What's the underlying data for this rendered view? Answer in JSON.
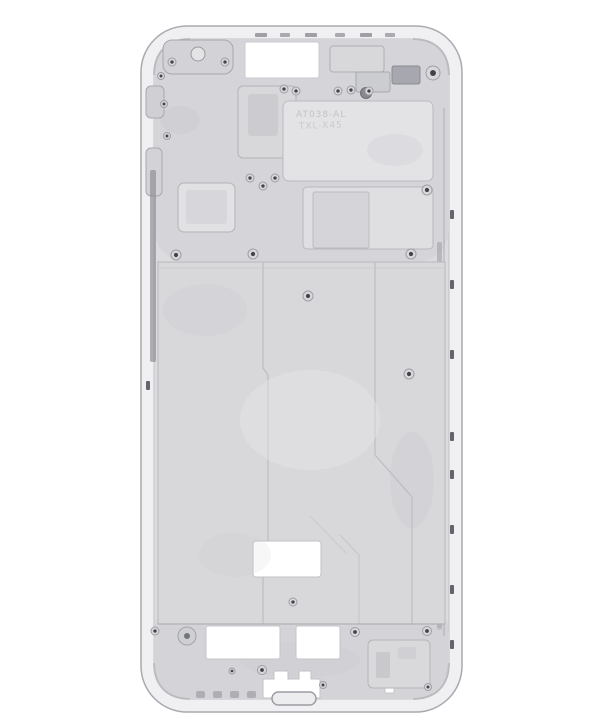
{
  "meta": {
    "subject": "smartphone-mid-frame-photo",
    "background": "#ffffff"
  },
  "palette": {
    "rim": "#f0f0f2",
    "rim_edge": "#a9a9af",
    "cavity": "#dcdcdf",
    "cavity_edge": "#c2c2c7",
    "zone": "#d5d5d9",
    "plate": "#d8d8db",
    "plate_edge": "#b9b9be",
    "cutout": "#ffffff",
    "cutout_edge": "#c4c4c9",
    "screw_ring": "#d8d8dc",
    "screw_edge": "#9e9ea4",
    "screw_hole": "#43434a",
    "groove_dark": "#8f8f96",
    "tick_dark": "#64646c"
  },
  "engraving": {
    "line1": "AT038-AL",
    "line2": "TXL-X45"
  },
  "svg": {
    "viewBox": "0 0 600 726",
    "width": 600,
    "height": 726,
    "shapes": [
      {
        "type": "rect",
        "name": "background",
        "x": 0,
        "y": 0,
        "w": 600,
        "h": 726,
        "fill": "#ffffff"
      },
      {
        "type": "rect",
        "name": "outer-frame-rim",
        "x": 141,
        "y": 26,
        "w": 321,
        "h": 686,
        "rx": 46,
        "fill": "#f0f0f2",
        "stroke": "#a9a9af",
        "sw": 1.5
      },
      {
        "type": "rect",
        "name": "inner-cavity",
        "x": 154,
        "y": 39,
        "w": 295,
        "h": 660,
        "rx": 33,
        "fill": "#dcdcdf",
        "stroke": "#c2c2c7",
        "sw": 1
      },
      {
        "type": "rect",
        "name": "top-machined-zone",
        "x": 154,
        "y": 39,
        "w": 295,
        "h": 223,
        "rx": 33,
        "fill": "#d5d5d9"
      },
      {
        "type": "rect",
        "name": "bottom-machined-zone",
        "x": 154,
        "y": 600,
        "w": 295,
        "h": 99,
        "rx": 33,
        "fill": "#d4d4d8"
      },
      {
        "type": "path",
        "name": "corner-shade-top-left",
        "d": "M154,75 Q155,40 190,39",
        "fill": "none",
        "stroke": "#a8a8af",
        "sw": 2,
        "op": 0.55
      },
      {
        "type": "path",
        "name": "corner-shade-top-right",
        "d": "M413,39 Q448,40 449,75",
        "fill": "none",
        "stroke": "#a8a8af",
        "sw": 2,
        "op": 0.55
      },
      {
        "type": "path",
        "name": "corner-shade-bottom-left",
        "d": "M154,663 Q155,698 190,699",
        "fill": "none",
        "stroke": "#a8a8af",
        "sw": 2,
        "op": 0.55
      },
      {
        "type": "path",
        "name": "corner-shade-bottom-right",
        "d": "M413,699 Q448,698 449,663",
        "fill": "none",
        "stroke": "#a8a8af",
        "sw": 2,
        "op": 0.55
      },
      {
        "type": "rect",
        "name": "top-rail-notch",
        "x": 255,
        "y": 33,
        "w": 12,
        "h": 4,
        "rx": 1,
        "fill": "#9fa0a6"
      },
      {
        "type": "rect",
        "name": "top-rail-notch",
        "x": 280,
        "y": 33,
        "w": 10,
        "h": 4,
        "rx": 1,
        "fill": "#aaabb1"
      },
      {
        "type": "rect",
        "name": "top-rail-notch",
        "x": 305,
        "y": 33,
        "w": 12,
        "h": 4,
        "rx": 1,
        "fill": "#9fa0a6"
      },
      {
        "type": "rect",
        "name": "top-rail-notch",
        "x": 335,
        "y": 33,
        "w": 10,
        "h": 4,
        "rx": 1,
        "fill": "#aaabb1"
      },
      {
        "type": "rect",
        "name": "top-rail-notch",
        "x": 360,
        "y": 33,
        "w": 12,
        "h": 4,
        "rx": 1,
        "fill": "#9fa0a6"
      },
      {
        "type": "rect",
        "name": "top-rail-notch",
        "x": 385,
        "y": 33,
        "w": 10,
        "h": 4,
        "rx": 1,
        "fill": "#aaabb1"
      },
      {
        "type": "rect",
        "name": "earpiece-bracket",
        "x": 163,
        "y": 40,
        "w": 70,
        "h": 34,
        "rx": 9,
        "fill": "#d3d3d7",
        "stroke": "#a6a6ad",
        "sw": 1
      },
      {
        "type": "circle",
        "name": "earpiece-boss",
        "cx": 198,
        "cy": 54,
        "r": 7,
        "fill": "#e4e4e7",
        "stroke": "#99999f",
        "sw": 1
      },
      {
        "type": "rect",
        "name": "top-center-cutout",
        "x": 245,
        "y": 42,
        "w": 74,
        "h": 36,
        "rx": 2,
        "fill": "#ffffff",
        "stroke": "#cbcbcf",
        "sw": 1
      },
      {
        "type": "rect",
        "name": "sensor-block",
        "x": 330,
        "y": 46,
        "w": 54,
        "h": 26,
        "rx": 3,
        "fill": "#d8d8db",
        "stroke": "#aeaeb4",
        "sw": 1
      },
      {
        "type": "rect",
        "name": "dark-connector-block",
        "x": 392,
        "y": 66,
        "w": 28,
        "h": 18,
        "rx": 2,
        "fill": "#a7a7af",
        "stroke": "#8a8a91",
        "sw": 1
      },
      {
        "type": "rect",
        "name": "camera-mount-block",
        "x": 356,
        "y": 72,
        "w": 34,
        "h": 20,
        "rx": 2,
        "fill": "#cccdd1",
        "stroke": "#a7a7ad",
        "sw": 1
      },
      {
        "type": "circle",
        "name": "camera-hole",
        "cx": 366,
        "cy": 93,
        "r": 5.5,
        "fill": "#888890",
        "stroke": "#6e6e75",
        "sw": 1
      },
      {
        "type": "rect",
        "name": "left-rail-boss",
        "x": 146,
        "y": 86,
        "w": 18,
        "h": 32,
        "rx": 5,
        "fill": "#d0d0d4",
        "stroke": "#a8a8ae",
        "sw": 1
      },
      {
        "type": "rect",
        "name": "left-rail-boss",
        "x": 146,
        "y": 148,
        "w": 16,
        "h": 48,
        "rx": 5,
        "fill": "#d3d3d7",
        "stroke": "#a8a8ae",
        "sw": 1
      },
      {
        "type": "rect",
        "name": "mid-top-block",
        "x": 238,
        "y": 86,
        "w": 58,
        "h": 72,
        "rx": 5,
        "fill": "#d8d8db",
        "stroke": "#b1b1b7",
        "sw": 1
      },
      {
        "type": "rect",
        "name": "mid-top-block-recess",
        "x": 248,
        "y": 94,
        "w": 30,
        "h": 42,
        "rx": 3,
        "fill": "#cbcbd0"
      },
      {
        "type": "rect",
        "name": "engraved-plate",
        "x": 283,
        "y": 101,
        "w": 150,
        "h": 80,
        "rx": 6,
        "fill": "#e3e3e6",
        "stroke": "#bbbbc0",
        "sw": 1
      },
      {
        "type": "text",
        "name": "engraving-line1",
        "x": 296,
        "y": 117,
        "size": 9,
        "fill": "#c2c2c8",
        "ls": 1,
        "text": "AT038-AL"
      },
      {
        "type": "text",
        "name": "engraving-line2",
        "x": 299,
        "y": 129,
        "size": 9,
        "fill": "#c9c9ce",
        "ls": 1,
        "rotate": -2,
        "text": "TXL-X45"
      },
      {
        "type": "rect",
        "name": "board-plate",
        "x": 303,
        "y": 187,
        "w": 130,
        "h": 62,
        "rx": 4,
        "fill": "#dfdfe2",
        "stroke": "#b8b8bd",
        "sw": 1
      },
      {
        "type": "rect",
        "name": "board-plate-recess",
        "x": 313,
        "y": 192,
        "w": 56,
        "h": 56,
        "rx": 2,
        "fill": "#d5d5d9",
        "stroke": "#bcbcc1",
        "sw": 1
      },
      {
        "type": "rect",
        "name": "left-square-pad",
        "x": 178,
        "y": 183,
        "w": 57,
        "h": 49,
        "rx": 6,
        "fill": "#e1e1e4",
        "stroke": "#b3b3b9",
        "sw": 1
      },
      {
        "type": "rect",
        "name": "left-square-pad-recess",
        "x": 186,
        "y": 190,
        "w": 41,
        "h": 34,
        "rx": 3,
        "fill": "#d7d7db"
      },
      {
        "type": "rect",
        "name": "left-side-groove",
        "x": 150,
        "y": 170,
        "w": 6,
        "h": 192,
        "rx": 2,
        "fill": "#8f8f96",
        "op": 0.7
      },
      {
        "type": "rect",
        "name": "right-side-groove",
        "x": 437,
        "y": 242,
        "w": 5,
        "h": 388,
        "rx": 2,
        "fill": "#9a9aa1",
        "op": 0.55
      },
      {
        "type": "path",
        "name": "right-rail-seam",
        "d": "M444,108 V636",
        "fill": "none",
        "stroke": "#b3b3b9",
        "sw": 1.5,
        "op": 0.8
      },
      {
        "type": "rect",
        "name": "right-edge-slot",
        "x": 450,
        "y": 210,
        "w": 4,
        "h": 9,
        "rx": 1,
        "fill": "#64646c"
      },
      {
        "type": "rect",
        "name": "right-edge-slot",
        "x": 450,
        "y": 280,
        "w": 4,
        "h": 9,
        "rx": 1,
        "fill": "#64646c"
      },
      {
        "type": "rect",
        "name": "right-edge-slot",
        "x": 450,
        "y": 350,
        "w": 4,
        "h": 9,
        "rx": 1,
        "fill": "#64646c"
      },
      {
        "type": "rect",
        "name": "right-edge-slot",
        "x": 450,
        "y": 432,
        "w": 4,
        "h": 9,
        "rx": 1,
        "fill": "#64646c"
      },
      {
        "type": "rect",
        "name": "right-edge-slot",
        "x": 450,
        "y": 470,
        "w": 4,
        "h": 9,
        "rx": 1,
        "fill": "#64646c"
      },
      {
        "type": "rect",
        "name": "right-edge-slot",
        "x": 450,
        "y": 525,
        "w": 4,
        "h": 9,
        "rx": 1,
        "fill": "#64646c"
      },
      {
        "type": "rect",
        "name": "right-edge-slot",
        "x": 450,
        "y": 585,
        "w": 4,
        "h": 9,
        "rx": 1,
        "fill": "#64646c"
      },
      {
        "type": "rect",
        "name": "right-edge-slot",
        "x": 450,
        "y": 640,
        "w": 4,
        "h": 9,
        "rx": 1,
        "fill": "#64646c"
      },
      {
        "type": "rect",
        "name": "left-edge-slot",
        "x": 146,
        "y": 381,
        "w": 4,
        "h": 9,
        "rx": 1,
        "fill": "#64646c"
      },
      {
        "type": "rect",
        "name": "display-plate",
        "x": 158,
        "y": 262,
        "w": 287,
        "h": 362,
        "fill": "#d8d8db",
        "stroke": "#b9b9be",
        "sw": 1
      },
      {
        "type": "path",
        "name": "plate-top-seam",
        "d": "M158,268 H445",
        "fill": "none",
        "stroke": "#c8c8cd",
        "sw": 1,
        "op": 0.8
      },
      {
        "type": "path",
        "name": "plate-step-left",
        "d": "M263,262 V368 l5,7 V558 l-5,7 V624",
        "fill": "none",
        "stroke": "#bdbdc2",
        "sw": 1.2
      },
      {
        "type": "path",
        "name": "plate-step-right",
        "d": "M375,262 V455 L412,497 V624",
        "fill": "none",
        "stroke": "#bdbdc2",
        "sw": 1.2
      },
      {
        "type": "path",
        "name": "plate-step-echo",
        "d": "M340,535 L359,555 V624",
        "fill": "none",
        "stroke": "#c5c5ca",
        "sw": 1
      },
      {
        "type": "path",
        "name": "plate-chamfer-accent",
        "d": "M310,516 L347,554",
        "fill": "none",
        "stroke": "#cbcbcf",
        "sw": 1
      },
      {
        "type": "rect",
        "name": "plate-window-cutout",
        "x": 253,
        "y": 541,
        "w": 68,
        "h": 36,
        "rx": 3,
        "fill": "#ffffff",
        "stroke": "#c2c2c7",
        "sw": 1
      },
      {
        "type": "ellipse",
        "name": "stain",
        "cx": 205,
        "cy": 310,
        "rx": 42,
        "ry": 26,
        "fill": "#c2c2c9",
        "op": 0.14
      },
      {
        "type": "ellipse",
        "name": "stain",
        "cx": 395,
        "cy": 150,
        "rx": 28,
        "ry": 16,
        "fill": "#bcbcc3",
        "op": 0.16
      },
      {
        "type": "ellipse",
        "name": "stain",
        "cx": 235,
        "cy": 555,
        "rx": 36,
        "ry": 22,
        "fill": "#c2c2c9",
        "op": 0.13
      },
      {
        "type": "ellipse",
        "name": "highlight-sheen",
        "cx": 310,
        "cy": 420,
        "rx": 70,
        "ry": 50,
        "fill": "#ececef",
        "op": 0.35
      },
      {
        "type": "ellipse",
        "name": "stain",
        "cx": 412,
        "cy": 480,
        "rx": 22,
        "ry": 48,
        "fill": "#b7b7bf",
        "op": 0.12
      },
      {
        "type": "ellipse",
        "name": "stain",
        "cx": 180,
        "cy": 120,
        "rx": 20,
        "ry": 14,
        "fill": "#b7b7bf",
        "op": 0.15
      },
      {
        "type": "ellipse",
        "name": "stain",
        "cx": 300,
        "cy": 660,
        "rx": 60,
        "ry": 18,
        "fill": "#c0c0c7",
        "op": 0.12
      },
      {
        "type": "path",
        "name": "plate-bottom-seam",
        "d": "M158,624 H445",
        "fill": "none",
        "stroke": "#b0b0b6",
        "sw": 1.2
      },
      {
        "type": "path",
        "name": "plate-bottom-seam-light",
        "d": "M160,629 H443",
        "fill": "none",
        "stroke": "#cfcfd4",
        "sw": 1,
        "op": 0.9
      },
      {
        "type": "rect",
        "name": "bottom-left-cutout",
        "x": 206,
        "y": 626,
        "w": 74,
        "h": 33,
        "rx": 2,
        "fill": "#ffffff",
        "stroke": "#c4c4c9",
        "sw": 1
      },
      {
        "type": "rect",
        "name": "bottom-right-cutout",
        "x": 296,
        "y": 626,
        "w": 44,
        "h": 33,
        "rx": 2,
        "fill": "#ffffff",
        "stroke": "#c4c4c9",
        "sw": 1
      },
      {
        "type": "circle",
        "name": "bottom-left-boss",
        "cx": 187,
        "cy": 636,
        "r": 9,
        "fill": "#cecfd3",
        "stroke": "#a3a3aa",
        "sw": 1
      },
      {
        "type": "circle",
        "name": "bottom-left-boss-hole",
        "cx": 187,
        "cy": 636,
        "r": 3,
        "fill": "#74747b"
      },
      {
        "type": "polygon",
        "name": "bottom-center-cutout",
        "points": "263,679 274,679 274,671 288,671 288,679 299,679 299,671 311,671 311,679 320,679 320,698 263,698",
        "fill": "#ffffff",
        "stroke": "#c2c2c7",
        "sw": 1
      },
      {
        "type": "rect",
        "name": "charging-port-slot",
        "x": 272,
        "y": 692,
        "w": 44,
        "h": 13,
        "rx": 6.5,
        "fill": "#ededf0",
        "stroke": "#9b9ba3",
        "sw": 1.5
      },
      {
        "type": "rect",
        "name": "bottom-small-cutout",
        "x": 385,
        "y": 678,
        "w": 9,
        "h": 15,
        "fill": "#ffffff",
        "stroke": "#c5c5ca",
        "sw": 1
      },
      {
        "type": "rect",
        "name": "bottom-right-pad",
        "x": 368,
        "y": 640,
        "w": 62,
        "h": 48,
        "rx": 5,
        "fill": "#d9d9dc",
        "stroke": "#b4b4ba",
        "sw": 1
      },
      {
        "type": "rect",
        "name": "bottom-right-pad-recess",
        "x": 376,
        "y": 652,
        "w": 14,
        "h": 26,
        "rx": 2,
        "fill": "#c8c8cd"
      },
      {
        "type": "rect",
        "name": "bottom-right-pad-recess",
        "x": 398,
        "y": 647,
        "w": 18,
        "h": 12,
        "rx": 2,
        "fill": "#d0d0d4"
      },
      {
        "type": "rect",
        "name": "bottom-rail-foot",
        "x": 196,
        "y": 691,
        "w": 9,
        "h": 7,
        "rx": 2,
        "fill": "#aeaeb5"
      },
      {
        "type": "rect",
        "name": "bottom-rail-foot",
        "x": 213,
        "y": 691,
        "w": 9,
        "h": 7,
        "rx": 2,
        "fill": "#aeaeb5"
      },
      {
        "type": "rect",
        "name": "bottom-rail-foot",
        "x": 230,
        "y": 691,
        "w": 9,
        "h": 7,
        "rx": 2,
        "fill": "#aeaeb5"
      },
      {
        "type": "rect",
        "name": "bottom-rail-foot",
        "x": 247,
        "y": 691,
        "w": 9,
        "h": 7,
        "rx": 2,
        "fill": "#aeaeb5"
      },
      {
        "type": "screw",
        "name": "screw-boss",
        "cx": 172,
        "cy": 62,
        "r": 4
      },
      {
        "type": "screw",
        "name": "screw-boss",
        "cx": 225,
        "cy": 62,
        "r": 4
      },
      {
        "type": "screw",
        "name": "screw-boss",
        "cx": 433,
        "cy": 73,
        "r": 7
      },
      {
        "type": "screw",
        "name": "screw-boss",
        "cx": 161,
        "cy": 76,
        "r": 3.5
      },
      {
        "type": "screw",
        "name": "screw-boss",
        "cx": 164,
        "cy": 104,
        "r": 3.5
      },
      {
        "type": "screw",
        "name": "screw-boss",
        "cx": 167,
        "cy": 136,
        "r": 3.5
      },
      {
        "type": "screw",
        "name": "screw-boss",
        "cx": 284,
        "cy": 89,
        "r": 4
      },
      {
        "type": "screw",
        "name": "screw-boss",
        "cx": 296,
        "cy": 91,
        "r": 4
      },
      {
        "type": "screw",
        "name": "screw-boss",
        "cx": 338,
        "cy": 91,
        "r": 4
      },
      {
        "type": "screw",
        "name": "screw-boss",
        "cx": 351,
        "cy": 90,
        "r": 4
      },
      {
        "type": "screw",
        "name": "screw-boss",
        "cx": 369,
        "cy": 91,
        "r": 4
      },
      {
        "type": "screw",
        "name": "screw-boss",
        "cx": 250,
        "cy": 178,
        "r": 4
      },
      {
        "type": "screw",
        "name": "screw-boss",
        "cx": 275,
        "cy": 178,
        "r": 4
      },
      {
        "type": "screw",
        "name": "screw-boss",
        "cx": 263,
        "cy": 186,
        "r": 4
      },
      {
        "type": "screw",
        "name": "screw-boss",
        "cx": 427,
        "cy": 190,
        "r": 5
      },
      {
        "type": "screw",
        "name": "screw-boss",
        "cx": 176,
        "cy": 255,
        "r": 5
      },
      {
        "type": "screw",
        "name": "screw-boss",
        "cx": 253,
        "cy": 254,
        "r": 5
      },
      {
        "type": "screw",
        "name": "screw-boss",
        "cx": 411,
        "cy": 254,
        "r": 5
      },
      {
        "type": "screw",
        "name": "screw-boss",
        "cx": 308,
        "cy": 296,
        "r": 5
      },
      {
        "type": "screw",
        "name": "screw-boss",
        "cx": 409,
        "cy": 374,
        "r": 5
      },
      {
        "type": "screw",
        "name": "screw-boss",
        "cx": 293,
        "cy": 602,
        "r": 4
      },
      {
        "type": "screw",
        "name": "screw-boss",
        "cx": 155,
        "cy": 631,
        "r": 4
      },
      {
        "type": "screw",
        "name": "screw-boss",
        "cx": 262,
        "cy": 670,
        "r": 4.5
      },
      {
        "type": "screw",
        "name": "screw-boss",
        "cx": 355,
        "cy": 632,
        "r": 4.5
      },
      {
        "type": "screw",
        "name": "screw-boss",
        "cx": 427,
        "cy": 631,
        "r": 4.5
      },
      {
        "type": "screw",
        "name": "screw-boss",
        "cx": 323,
        "cy": 685,
        "r": 3.5
      },
      {
        "type": "screw",
        "name": "screw-boss",
        "cx": 428,
        "cy": 687,
        "r": 3.5
      },
      {
        "type": "screw",
        "name": "screw-boss",
        "cx": 232,
        "cy": 671,
        "r": 3
      }
    ]
  }
}
